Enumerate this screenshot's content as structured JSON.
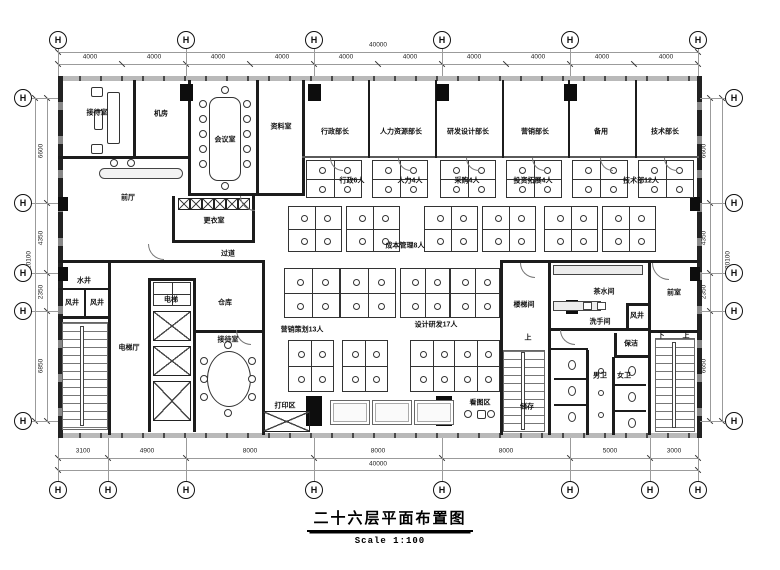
{
  "title": {
    "text": "二十六层平面布置图",
    "scale": "Scale  1:100"
  },
  "axis": {
    "bubble": "H"
  },
  "dimensions": {
    "top": {
      "segments": [
        "4000",
        "4000",
        "4000",
        "4000",
        "4000",
        "4000",
        "4000",
        "4000",
        "4000",
        "4000"
      ],
      "total": "40000"
    },
    "bottom": {
      "segments": [
        "3100",
        "4900",
        "8000",
        "8000",
        "8000",
        "5000",
        "3000"
      ],
      "total": "40000"
    },
    "left": {
      "segments": [
        "6600",
        "4350",
        "2350",
        "6850"
      ],
      "total": "20100"
    },
    "right": {
      "segments": [
        "6600",
        "4350",
        "2350",
        "6650"
      ],
      "total": "20100"
    }
  },
  "rooms": {
    "reception": "接待室",
    "machine": "机房",
    "meeting": "会议室",
    "archive": "资料室",
    "lobby": "前厅",
    "changing": "更衣室",
    "corridor": "过道",
    "admin_dir": "行政部长",
    "hr_dir": "人力资源部长",
    "rnd_dir": "研发设计部长",
    "mkt_dir": "营销部长",
    "spare": "备用",
    "tech_dir": "技术部长",
    "admin_staff": "行政6人",
    "hr_staff": "人力4人",
    "proc_staff": "采购4人",
    "invest_staff": "投资拓展4人",
    "tech_staff": "技术部12人",
    "cost_staff": "成本管理8人",
    "mkt_staff": "营销策划13人",
    "design_staff": "设计研发17人",
    "print_area": "打印区",
    "view_area": "看图区",
    "water_shaft": "水井",
    "air_shaft": "风井",
    "elev_hall": "电梯厅",
    "elevator": "电梯",
    "warehouse": "仓库",
    "stair_room": "楼梯间",
    "tea_room": "茶水间",
    "washroom": "洗手间",
    "cleaning": "保洁",
    "mens": "男卫",
    "womens": "女卫",
    "storage": "储存",
    "vestibule": "前室",
    "up": "上",
    "down": "下"
  }
}
